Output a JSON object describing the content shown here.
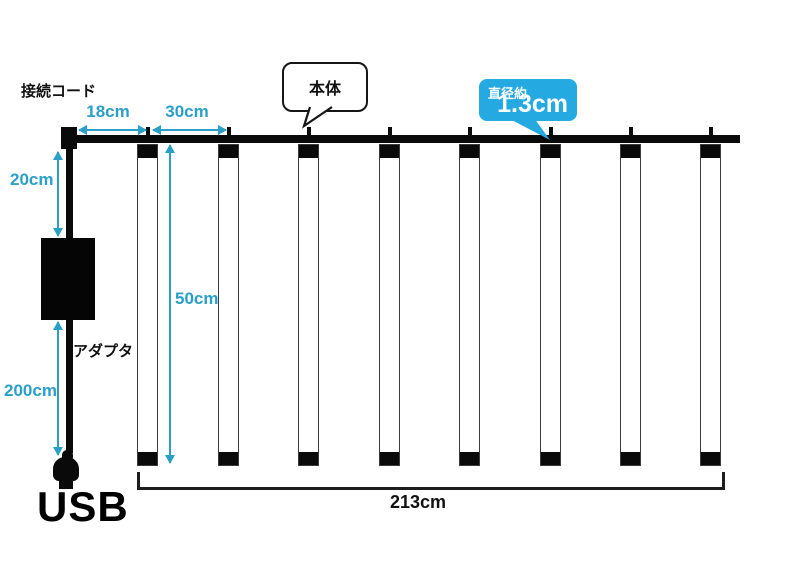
{
  "labels": {
    "connection_cord": "接続コード",
    "main_body": "本体",
    "diameter_prefix": "直径約",
    "diameter_value": "1.3cm",
    "adapter": "アダプタ",
    "usb": "USB"
  },
  "dimensions": {
    "offset_left": "18cm",
    "tube_spacing": "30cm",
    "cord_to_adapter": "20cm",
    "tube_length": "50cm",
    "adapter_to_usb": "200cm",
    "total_width": "213cm"
  },
  "tube_count": 8,
  "colors": {
    "dimension_accent": "#2a9fc7",
    "badge_background": "#24a9e1",
    "hardware_black": "#0a0a0a"
  }
}
